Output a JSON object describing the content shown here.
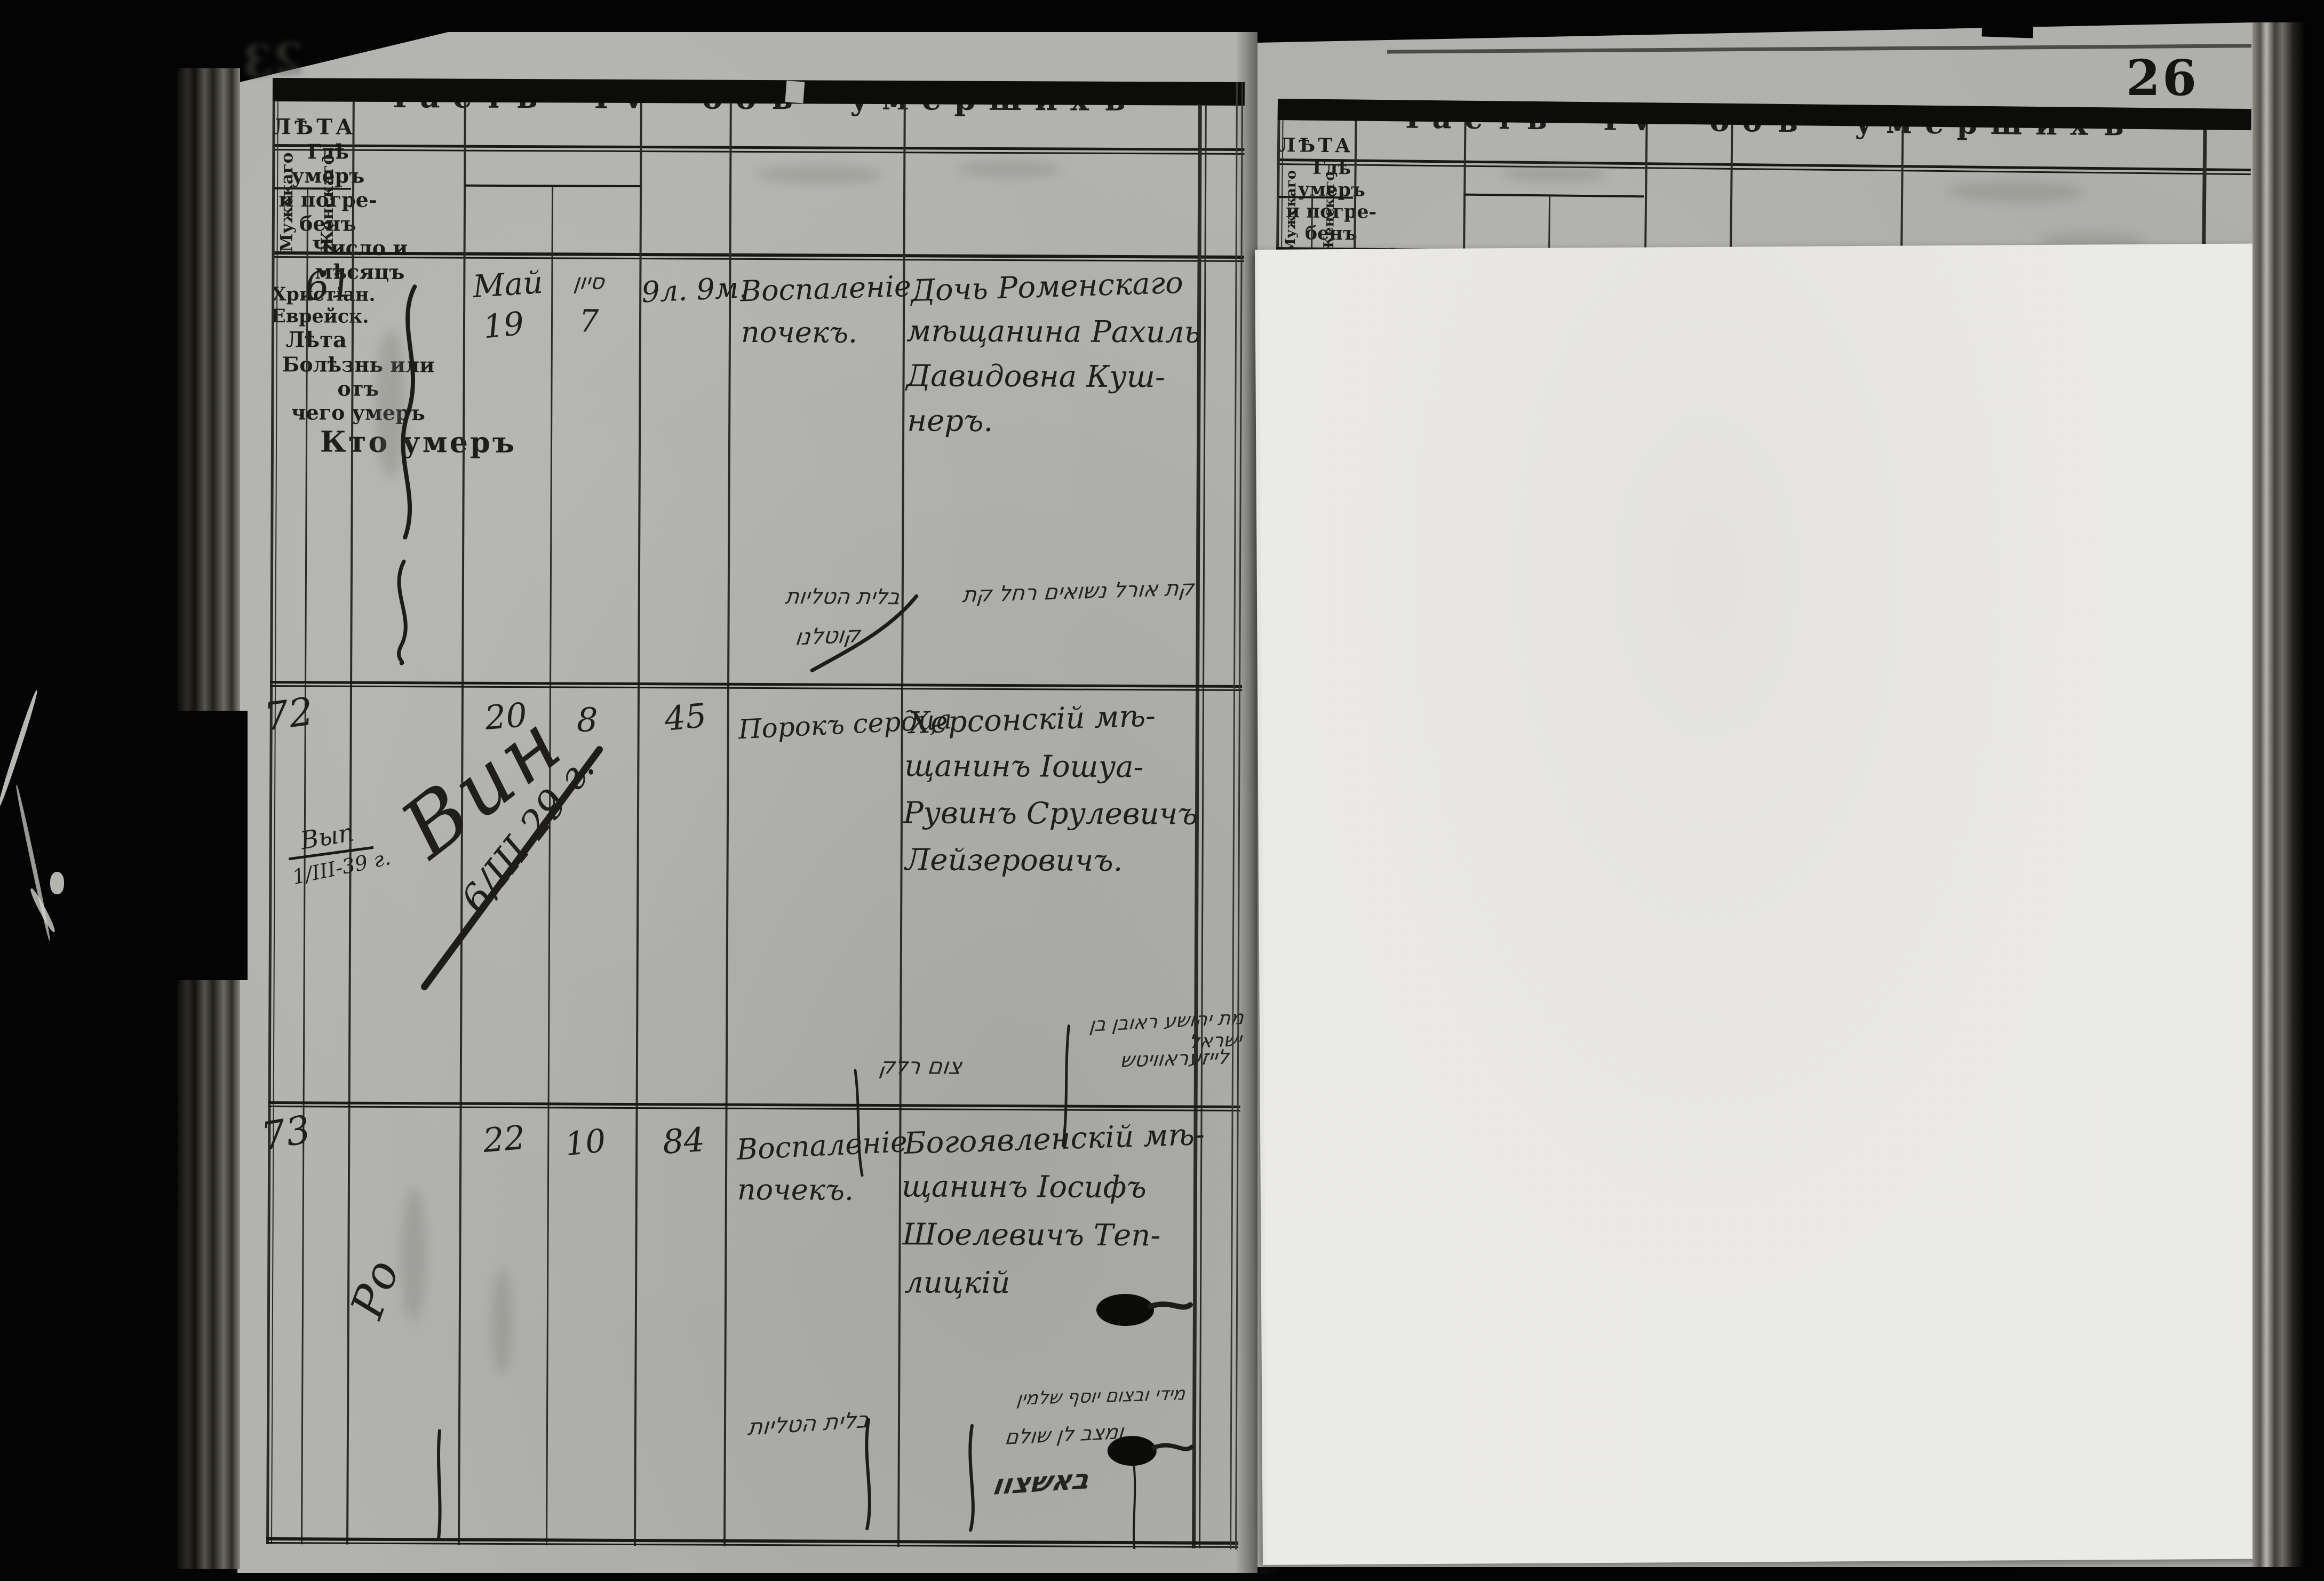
{
  "page_number": "26",
  "ghost_page_number": "23",
  "title": "Часть IV объ умершихъ",
  "colors": {
    "paper": "#b2b2ae",
    "overlay_sheet": "#eae9e5",
    "ink": "#1d1c19"
  },
  "columns": {
    "age_group": "ЛѢТА",
    "male": "Мужскаго",
    "female": "Женскаго",
    "where_lines": [
      "Гдѣ умеръ",
      "и погре-",
      "бенъ"
    ],
    "date_group": "Число и мѣсяцъ",
    "christian": "Христіан.",
    "jewish": "Еврейск.",
    "age": "Лѣта",
    "disease_lines": [
      "Болѣзнь или отъ",
      "чего умеръ"
    ],
    "who": "Кто умеръ"
  },
  "entries": [
    {
      "number": "61",
      "sex_column": "Женскаго",
      "christian_month": "Май",
      "christian_day": "19",
      "jewish_month": "סיון",
      "jewish_day": "7",
      "age": "9л. 9м.",
      "disease_lines": [
        "Воспаленіе",
        "почекъ."
      ],
      "who_lines": [
        "Дочь Роменскаго",
        "мѣщанина Рахиль",
        "Давидовна Куш-",
        "неръ."
      ],
      "hebrew_note_lines": [
        "קת אורל נשואים רחל קת",
        "בלית הטליות",
        "קוטלנו"
      ]
    },
    {
      "number": "72",
      "sex_column": "Мужскаго",
      "where_note": "Вин",
      "date_annotation": "6/ІІІ 29 г.",
      "margin_note_lines": [
        "Вып",
        "1/ІІІ-39 г."
      ],
      "christian_day": "20",
      "jewish_day": "8",
      "age": "45",
      "disease_lines": [
        "Порокъ сердца"
      ],
      "who_lines": [
        "Херсонскій мѣ-",
        "щанинъ Іошуа-",
        "Рувинъ Срулевичъ",
        "Лейзеровичъ."
      ],
      "hebrew_note_lines": [
        "מת יהושע ראובן בן ישראל",
        "לייזעראוויטש",
        "צום רלק"
      ]
    },
    {
      "number": "73",
      "sex_column": "Мужскаго",
      "where_note": "Ро",
      "christian_day": "22",
      "jewish_day": "10",
      "age": "84",
      "disease_lines": [
        "Воспаленіе",
        "почекъ."
      ],
      "who_lines": [
        "Богоявленскій мѣ-",
        "щанинъ Іосифъ",
        "Шоелевичъ Теп-",
        "лицкій"
      ],
      "hebrew_note_lines": [
        "בלית הטליות",
        "מידי ובצום יוסף שלמין",
        "ומצב לן שולם",
        "באשצוו"
      ]
    }
  ]
}
